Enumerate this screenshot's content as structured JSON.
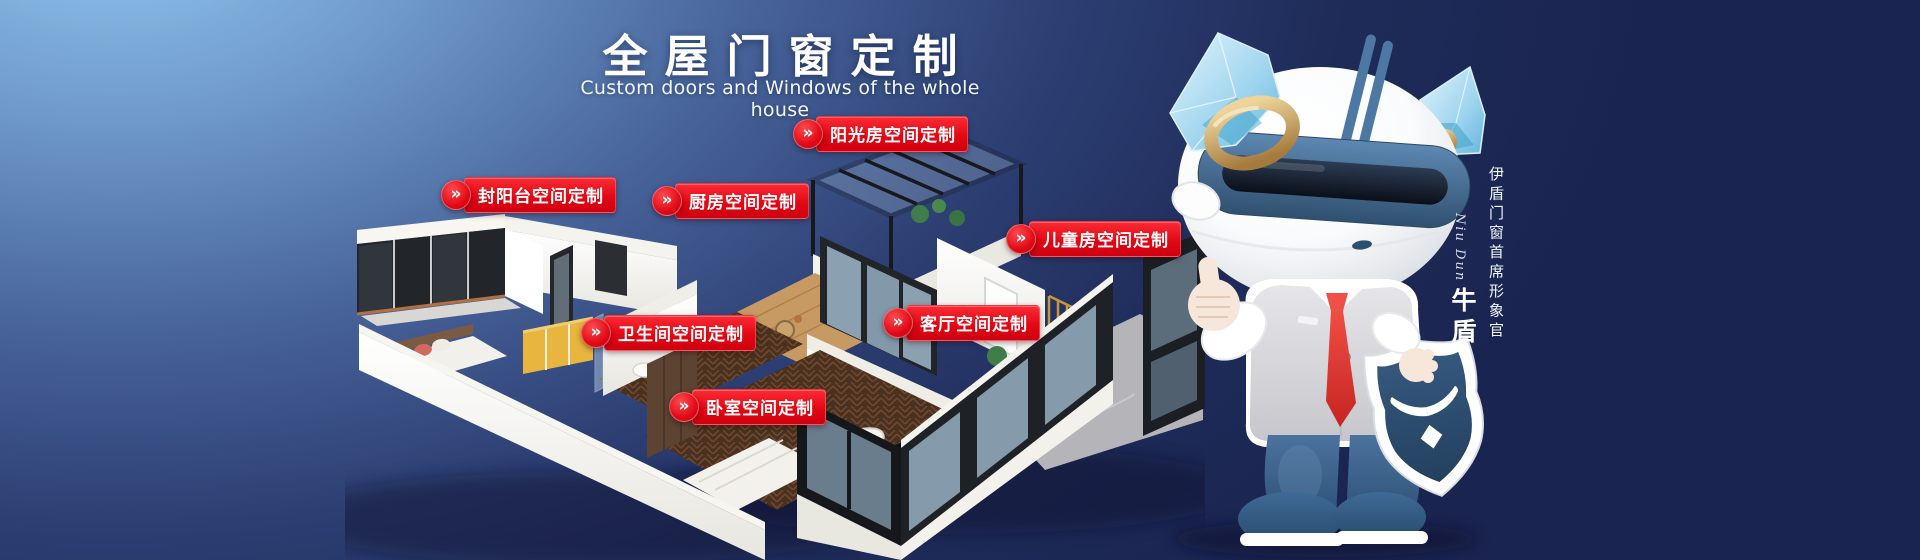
{
  "banner": {
    "title": "全屋门窗定制",
    "subtitle": "Custom doors and Windows of the whole house"
  },
  "icons": {
    "chevron": "»"
  },
  "room_labels": [
    {
      "key": "sunroom",
      "label": "阳光房空间定制"
    },
    {
      "key": "enclosed-balcony",
      "label": "封阳台空间定制"
    },
    {
      "key": "kitchen",
      "label": "厨房空间定制"
    },
    {
      "key": "children-room",
      "label": "儿童房空间定制"
    },
    {
      "key": "bathroom",
      "label": "卫生间空间定制"
    },
    {
      "key": "living-room",
      "label": "客厅空间定制"
    },
    {
      "key": "bedroom",
      "label": "卧室空间定制"
    }
  ],
  "mascot": {
    "role_caption": "伊盾门窗首席形象官",
    "name_script": "Niu Dun",
    "name": "牛盾"
  },
  "colors": {
    "accent_red": "#e20814",
    "bg_light_blue": "#92c6f1",
    "bg_navy": "#18224a",
    "mascot_suit_blue": "#3c6590",
    "shield_navy": "#2d4f7a",
    "screen_gold": "#c8963e",
    "wardrobe_yellow": "#e8b63e"
  }
}
